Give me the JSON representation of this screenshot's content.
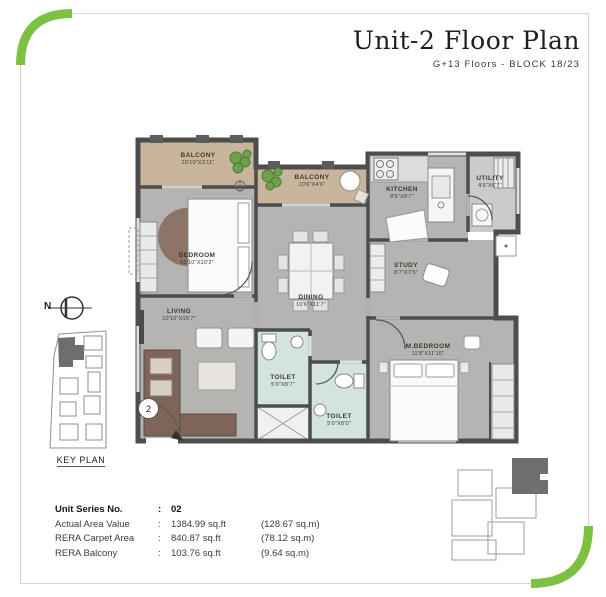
{
  "header": {
    "title": "Unit-2 Floor Plan",
    "subtitle": "G+13 Floors - BLOCK 18/23"
  },
  "plan": {
    "entry_marker": "2",
    "north_label": "N",
    "key_plan_label": "KEY PLAN",
    "rooms": [
      {
        "name": "BALCONY",
        "dim": "10'10\"X3'11\""
      },
      {
        "name": "BALCONY",
        "dim": "10'6\"X4'6\""
      },
      {
        "name": "KITCHEN",
        "dim": "8'6\"X8'7\""
      },
      {
        "name": "UTILITY",
        "dim": "4'6\"X6'7\""
      },
      {
        "name": "BEDROOM",
        "dim": "10'10\"X10'2\""
      },
      {
        "name": "STUDY",
        "dim": "8'7\"X7'5\""
      },
      {
        "name": "DINING",
        "dim": "10'6\"X11'7\""
      },
      {
        "name": "LIVING",
        "dim": "10'10\"X15'7\""
      },
      {
        "name": "TOILET",
        "dim": "5'0\"X8'7\""
      },
      {
        "name": "TOILET",
        "dim": "5'0\"X8'0\""
      },
      {
        "name": "M.BEDROOM",
        "dim": "11'8\"X11'10\""
      }
    ]
  },
  "info": {
    "colon": ":",
    "rows": [
      {
        "label": "Unit Series No.",
        "sqft": "02",
        "sqm": ""
      },
      {
        "label": "Actual Area Value",
        "sqft": "1384.99 sq.ft",
        "sqm": "(128.67 sq.m)"
      },
      {
        "label": "RERA Carpet Area",
        "sqft": "840.87 sq.ft",
        "sqm": "(78.12 sq.m)"
      },
      {
        "label": "RERA Balcony",
        "sqft": "103.76 sq.ft",
        "sqm": "(9.64 sq.m)"
      }
    ]
  },
  "colors": {
    "accent_green": "#7cc142",
    "wall": "#4d4d4d",
    "floor": "#b6b4b2",
    "balcony": "#c9b49c",
    "toilet": "#d3e4e0"
  }
}
